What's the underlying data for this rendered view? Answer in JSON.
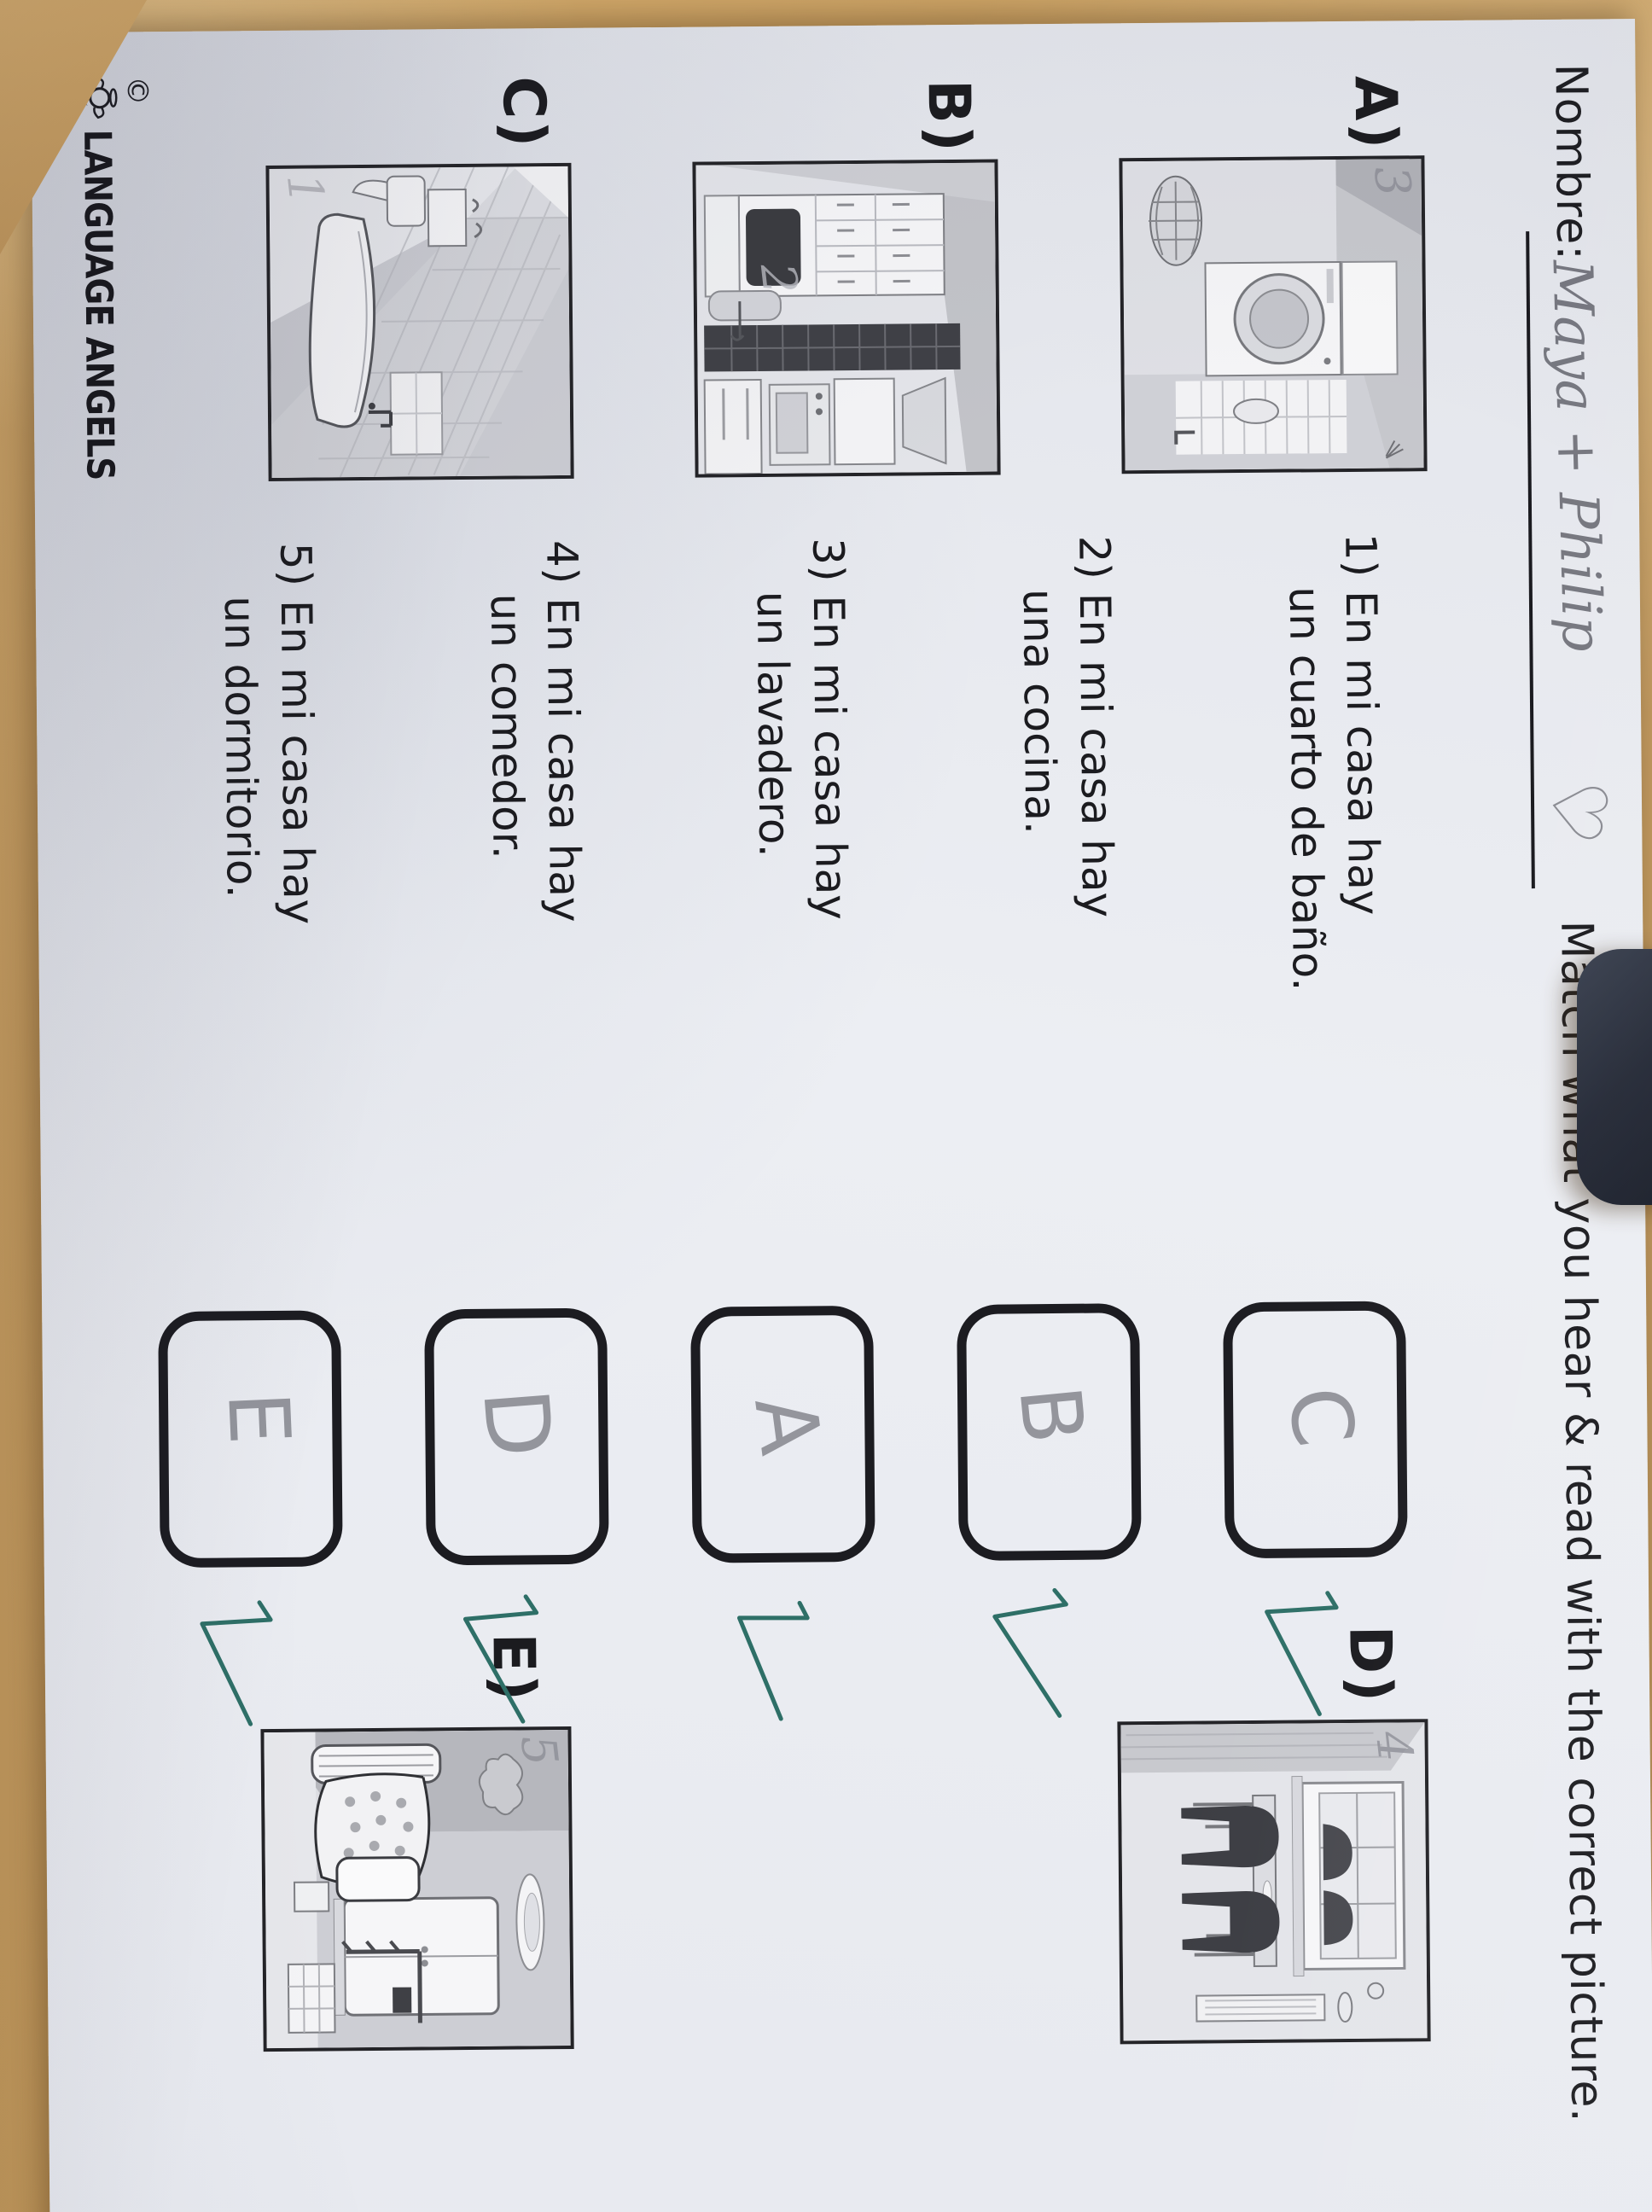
{
  "header": {
    "name_label": "Nombre:",
    "student_name": "Maya + Philip",
    "heart": "♡",
    "title": "Match what you hear & read with the correct picture."
  },
  "pictures": [
    {
      "label": "A)",
      "room": "laundry-room",
      "pencil_number": "3"
    },
    {
      "label": "B)",
      "room": "kitchen",
      "pencil_number": "2"
    },
    {
      "label": "C)",
      "room": "bathroom",
      "pencil_number": "1"
    },
    {
      "label": "D)",
      "room": "dining-room",
      "pencil_number": "4"
    },
    {
      "label": "E)",
      "room": "bedroom",
      "pencil_number": "5"
    }
  ],
  "questions": [
    {
      "number": "1)",
      "line1": "En mi casa hay",
      "line2": "un cuarto de baño.",
      "answer": "C"
    },
    {
      "number": "2)",
      "line1": "En mi casa hay",
      "line2": "una cocina.",
      "answer": "B"
    },
    {
      "number": "3)",
      "line1": "En mi casa hay",
      "line2": "un lavadero.",
      "answer": "A"
    },
    {
      "number": "4)",
      "line1": "En mi casa hay",
      "line2": "un comedor.",
      "answer": "D"
    },
    {
      "number": "5)",
      "line1": "En mi casa hay",
      "line2": "un dormitorio.",
      "answer": "E"
    }
  ],
  "footer": {
    "copyright": "©",
    "logo_text": "LANGUAGE ANGELS"
  },
  "colors": {
    "ink": "#1b1b1f",
    "pencil": "#85868e",
    "check": "#2e6f67",
    "desk": "#c39a5e",
    "paper": "#e9ebf0",
    "dark_object": "#242936"
  }
}
